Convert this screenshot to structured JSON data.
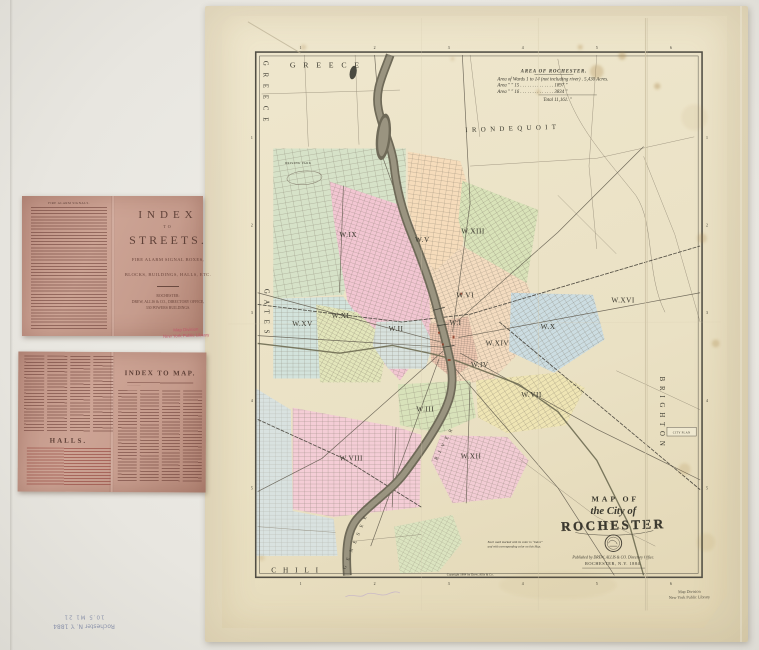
{
  "photo": {
    "background": "#e9e7e1",
    "board_color": "#e4dabd",
    "sheet_color": "#eae1c4",
    "panel_color": "#c69c8d"
  },
  "booklet_cover": {
    "list_header": "FIRE ALARM SIGNALS.",
    "title_line1": "INDEX",
    "title_to": "TO",
    "title_line2": "STREETS.",
    "subtitle1": "FIRE ALARM SIGNAL BOXES,",
    "subtitle2": "BLOCKS, BUILDINGS, HALLS, ETC.",
    "imprint_city": "ROCHESTER:",
    "imprint_publisher": "DREW, ALLIS & CO., DIRECTORY OFFICE,",
    "imprint_address": "330 POWERS BUILDINGS."
  },
  "library_stamp": {
    "line1": "Map Division",
    "line2": "New York Public Library",
    "color": "#c2566a"
  },
  "index_spread": {
    "title": "INDEX TO MAP.",
    "halls_title": "HALLS."
  },
  "shelfmark": {
    "line1": "Rochester N. Y. 1884",
    "line2": "10.5 M1 21"
  },
  "map": {
    "towns": {
      "greece_top": "GREECE",
      "greece_side": "GREECE",
      "irondequoit": "IRONDEQUOIT",
      "gates": "GATES",
      "brighton": "BRIGHTON",
      "chili": "CHILI"
    },
    "river": {
      "word1": "GENESEE",
      "word2": "RIVER"
    },
    "area_table": {
      "title": "AREA OF ROCHESTER.",
      "row1": "Area of Wards 1 to 14 (not including river) . 5,430 Acres.",
      "row2": "Area   ″    ″   15 . . . . . . . . . . . . . .  1897    ″",
      "row3": "Area   ″    ″   16 . . . . . . . . . . . . . .  3834    ″",
      "row4": "Total  11,161.    ″"
    },
    "wards": [
      "W.I",
      "W.II",
      "W.III",
      "W.IV",
      "W.V",
      "W.VI",
      "W.VII",
      "W.VIII",
      "W.IX",
      "W.X",
      "W.XI",
      "W.XII",
      "W.XIII",
      "W.XIV",
      "W.XV",
      "W.XVI"
    ],
    "title_block": {
      "line1": "MAP OF",
      "line2": "the City of",
      "line3": "ROCHESTER",
      "pub1": "Published by DREW, ALLIS & CO. Directory Office.",
      "pub2": "ROCHESTER, N.Y. 1884."
    },
    "notes": {
      "ward_note1": "Each ward marked with its color in “Index”",
      "ward_note2": "and with corresponding color on this Map.",
      "copyright": "Copyright 1884 by Drew, Allis & Co.",
      "city_plan": "CITY PLAN",
      "driving_park": "DRIVING PARK"
    },
    "border": {
      "top": [
        "1",
        "2",
        "3",
        "4",
        "5",
        "6"
      ],
      "bottom": [
        "1",
        "2",
        "3",
        "4",
        "5",
        "6"
      ],
      "left": [
        "1",
        "2",
        "3",
        "4",
        "5"
      ],
      "right": [
        "1",
        "2",
        "3",
        "4",
        "5"
      ]
    }
  }
}
